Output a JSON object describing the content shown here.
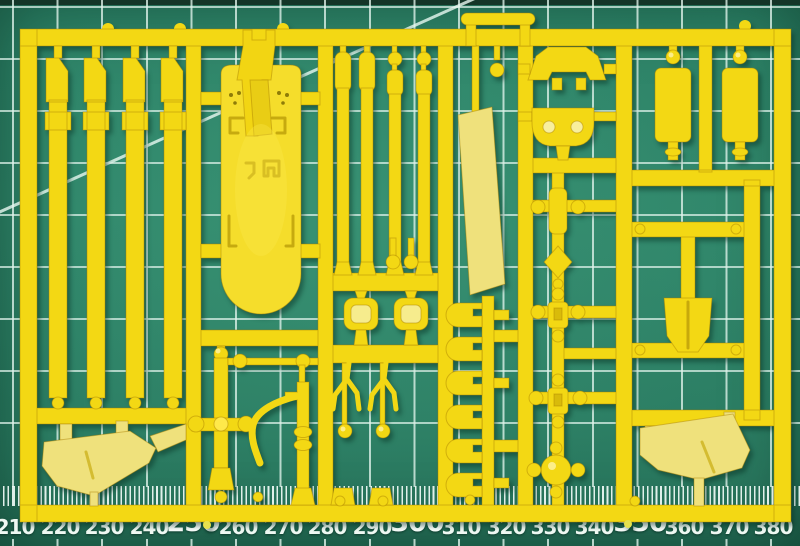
{
  "scene": {
    "title": "Yellow plastic model-kit sprue on green cutting mat",
    "object": "injection-molded parts sprue (unpainted yellow styrene)",
    "surface": "self-healing cutting mat with white 10 mm grid, diagonal guide line and millimetre ruler scale"
  },
  "colors": {
    "mat_green": "#2f8569",
    "mat_edge_dark": "#143528",
    "grid_white": "#e0f3eb",
    "sprue_yellow": "#f3d814",
    "sprue_pale": "#efe17c",
    "sprue_bright": "#ffe94a",
    "sprue_shade": "#c9a606",
    "ruler_text": "#eef8f2"
  },
  "ruler": {
    "unit": "mm",
    "labels": [
      {
        "text": "210",
        "major": false
      },
      {
        "text": "220",
        "major": false
      },
      {
        "text": "230",
        "major": false
      },
      {
        "text": "240",
        "major": false
      },
      {
        "text": "250",
        "major": true
      },
      {
        "text": "260",
        "major": false
      },
      {
        "text": "270",
        "major": false
      },
      {
        "text": "280",
        "major": false
      },
      {
        "text": "290",
        "major": false
      },
      {
        "text": "300",
        "major": true
      },
      {
        "text": "310",
        "major": false
      },
      {
        "text": "320",
        "major": false
      },
      {
        "text": "330",
        "major": false
      },
      {
        "text": "340",
        "major": false
      },
      {
        "text": "350",
        "major": true
      },
      {
        "text": "360",
        "major": false
      },
      {
        "text": "370",
        "major": false
      },
      {
        "text": "380",
        "major": false
      }
    ]
  },
  "sprue_contents": {
    "long_rail_strips": 4,
    "thin_rod_strips": 4,
    "large_deck_hull_part": 1,
    "flat_fender_panels": 2,
    "angled_flat_panel": 1,
    "clip_ladder_parts": 6,
    "cross_link_chain_parts": 4,
    "box_tank_parts": 2,
    "arch_and_tub_parts": 2,
    "h_frame_with_shovel": 1,
    "bent_pipe_parts": 2
  }
}
